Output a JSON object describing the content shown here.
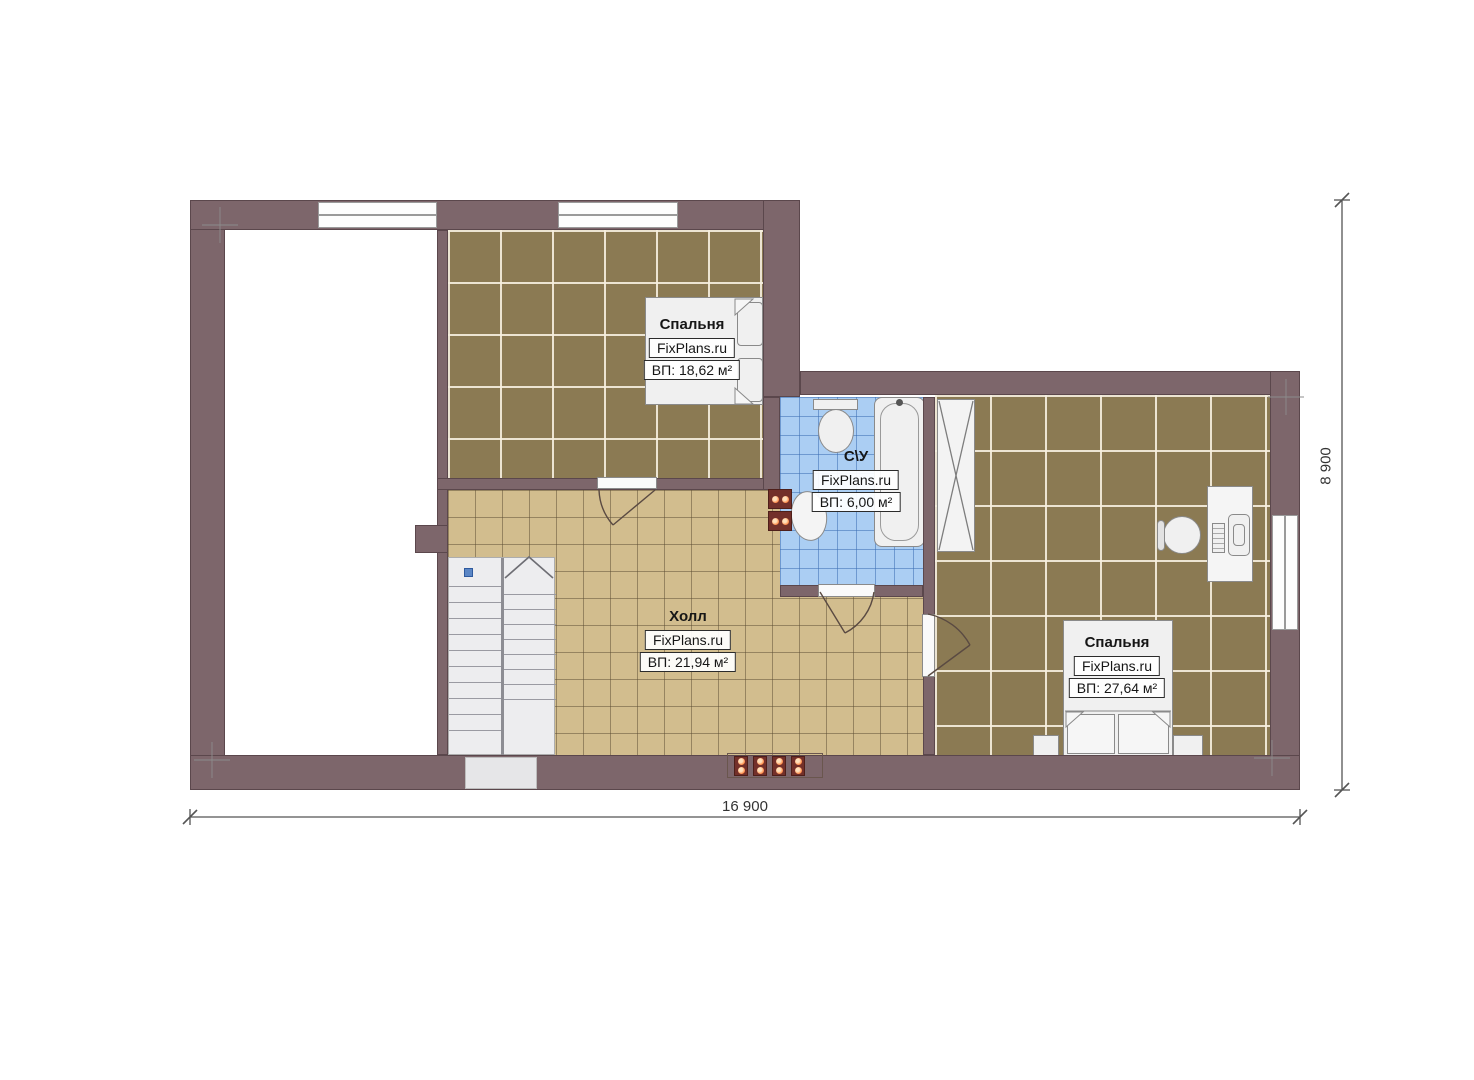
{
  "colors": {
    "wall": "#7d666b",
    "wall_edge": "#5b474c",
    "floor_brown": "#8b7a53",
    "floor_tan": "#d2bd8e",
    "floor_blue": "#abcef3",
    "fixture": "#f0f0f0",
    "fixture_edge": "#8a8a8a",
    "radiator_body": "#73302a",
    "radiator_dot": "#ff8844",
    "dimension": "#444444"
  },
  "rooms": [
    {
      "name": "Спальня",
      "brand": "FixPlans.ru",
      "area": "ВП: 18,62 м²"
    },
    {
      "name": "С\\У",
      "brand": "FixPlans.ru",
      "area": "ВП: 6,00 м²"
    },
    {
      "name": "Холл",
      "brand": "FixPlans.ru",
      "area": "ВП: 21,94 м²"
    },
    {
      "name": "Спальня",
      "brand": "FixPlans.ru",
      "area": "ВП: 27,64 м²"
    }
  ],
  "dimensions": {
    "width": "16 900",
    "height": "8 900"
  }
}
